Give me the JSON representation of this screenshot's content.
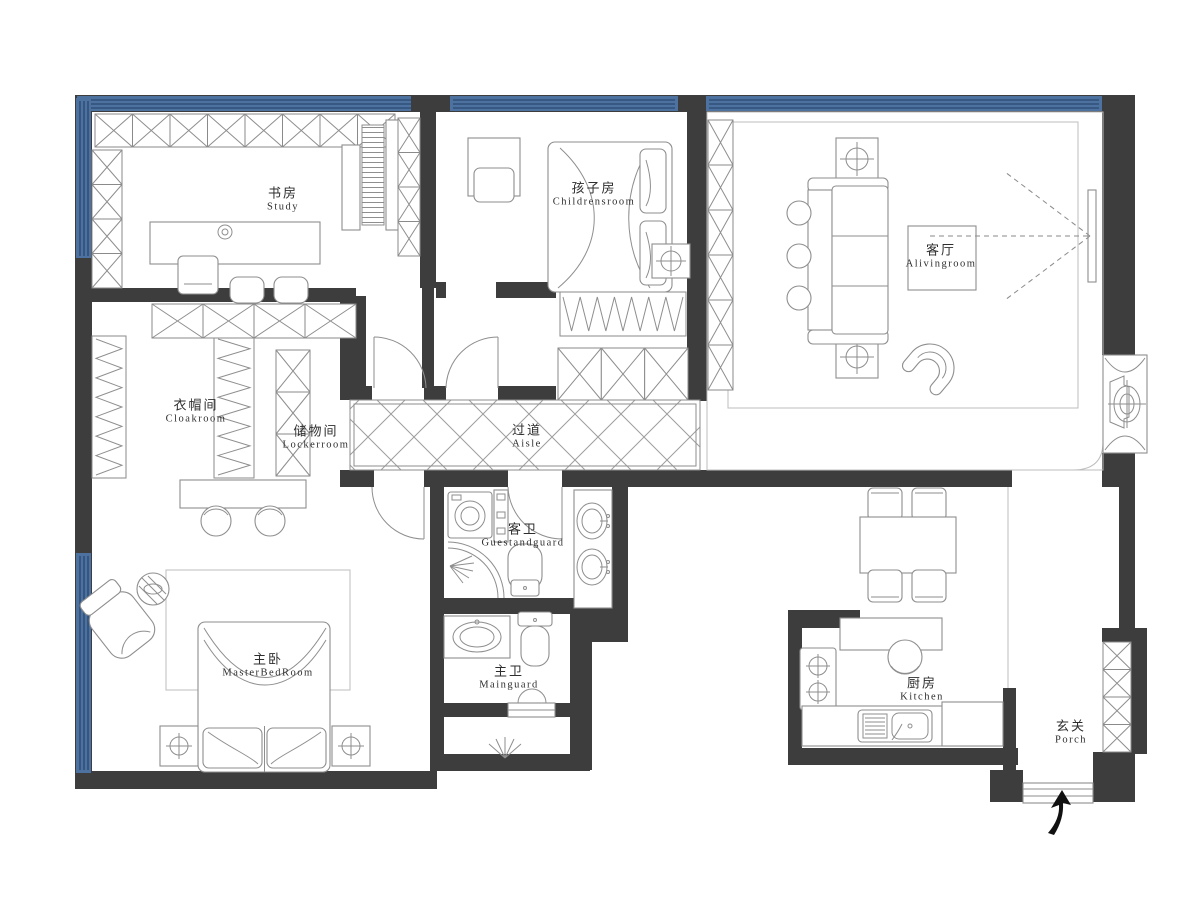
{
  "meta": {
    "drawing_type": "residential apartment floor plan",
    "style": "black-and-white CAD line drawing with blue window bands"
  },
  "colors": {
    "wall": "#3d3d3d",
    "window_band": "#4e72a0",
    "window_stripe": "#2e4f78",
    "furniture_line": "#8e8e8e",
    "label_text": "#2e2e2e",
    "background": "#ffffff"
  },
  "rooms": [
    {
      "id": "study",
      "name_zh": "书房",
      "name_en": "Study"
    },
    {
      "id": "childrens-room",
      "name_zh": "孩子房",
      "name_en": "Childrensroom"
    },
    {
      "id": "living-room",
      "name_zh": "客厅",
      "name_en": "Alivingroom"
    },
    {
      "id": "cloakroom",
      "name_zh": "衣帽间",
      "name_en": "Cloakroom"
    },
    {
      "id": "locker-room",
      "name_zh": "储物间",
      "name_en": "Lockerroom"
    },
    {
      "id": "aisle",
      "name_zh": "过道",
      "name_en": "Aisle"
    },
    {
      "id": "guest-bathroom",
      "name_zh": "客卫",
      "name_en": "Guestandguard"
    },
    {
      "id": "master-bedroom",
      "name_zh": "主卧",
      "name_en": "MasterBedRoom"
    },
    {
      "id": "main-bathroom",
      "name_zh": "主卫",
      "name_en": "Mainguard"
    },
    {
      "id": "kitchen",
      "name_zh": "厨房",
      "name_en": "Kitchen"
    },
    {
      "id": "porch",
      "name_zh": "玄关",
      "name_en": "Porch"
    }
  ],
  "furniture_symbols": {
    "study": [
      "wall-x-cabinets",
      "desk",
      "office-chair",
      "bookshelf",
      "stools"
    ],
    "childrens_room": [
      "desk",
      "chair",
      "single-bed",
      "ceiling-lamp",
      "clothes-rack",
      "x-cabinets"
    ],
    "living_room": [
      "rug",
      "three-seat-sofa",
      "round-side-tables",
      "coffee-table",
      "armchair",
      "tv",
      "downlight-boxes",
      "fan-coil-unit",
      "tv-sightline-dashes"
    ],
    "cloakroom": [
      "hanging-rack-left",
      "hanging-rack-right",
      "x-cabinet-row"
    ],
    "locker_room": [
      "x-cabinet-column"
    ],
    "aisle": [
      "diamond-tile-floor"
    ],
    "guest_bathroom": [
      "washing-machine",
      "slim-cabinet",
      "corner-shower",
      "spray-symbol",
      "toilet",
      "double-washbasin"
    ],
    "master_bedroom": [
      "dressing-desk",
      "round-stools",
      "rug",
      "double-bed",
      "pillows",
      "nightstands",
      "bedside-lamp-symbols",
      "lounge-chair",
      "striped-side-table"
    ],
    "main_bathroom": [
      "washbasin-counter",
      "toilet",
      "door-sill",
      "light-rays-symbol"
    ],
    "kitchen": [
      "bar-counter",
      "bar-stool",
      "gas-stove-two-burners",
      "sink-counter",
      "sink"
    ],
    "porch": [
      "shoe-x-cabinets",
      "entry-threshold"
    ]
  },
  "windows": [
    "top-wall-band-left",
    "top-wall-band-middle",
    "top-wall-band-right",
    "left-wall-study-band",
    "left-wall-master-band"
  ],
  "entrance": {
    "symbol": "curved-black-arrow",
    "location": "below porch threshold"
  }
}
